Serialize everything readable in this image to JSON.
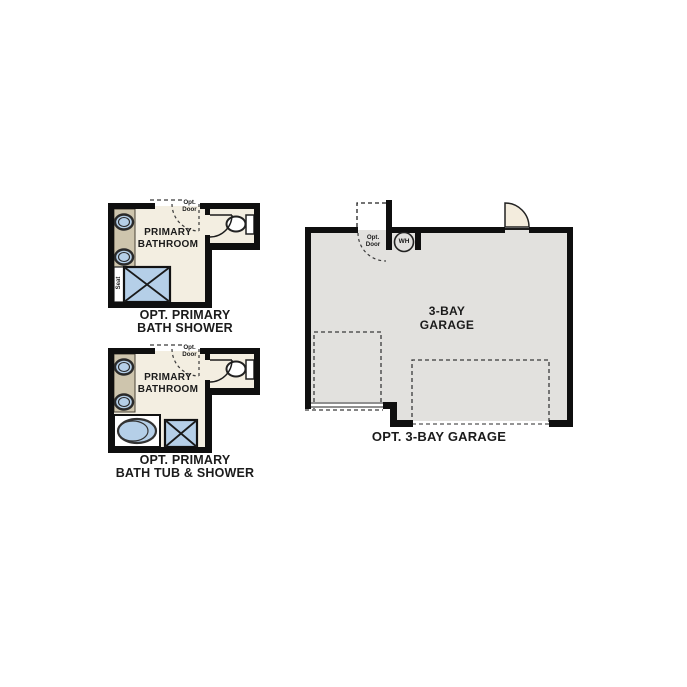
{
  "page": {
    "background": "#ffffff"
  },
  "colors": {
    "wall": "#0f0f0f",
    "floor": "#f3eee1",
    "vanity": "#cec5ad",
    "blue": "#b5cfe8",
    "garage": "#e2e1de",
    "doorfill": "#f3ecdd",
    "text": "#1b1b1b",
    "dash": "#3a3a3a"
  },
  "plans": {
    "bath_shower": {
      "room_label": "PRIMARY\nBATHROOM",
      "caption": "OPT. PRIMARY\nBATH SHOWER",
      "opt_door_label": "Opt.\nDoor",
      "seat_label": "Seat"
    },
    "bath_tub_shower": {
      "room_label": "PRIMARY\nBATHROOM",
      "caption": "OPT. PRIMARY\nBATH TUB & SHOWER",
      "opt_door_label": "Opt.\nDoor"
    },
    "garage": {
      "room_label": "3-BAY\nGARAGE",
      "caption": "OPT. 3-BAY GARAGE",
      "opt_door_label": "Opt.\nDoor",
      "water_heater_label": "WH"
    }
  }
}
